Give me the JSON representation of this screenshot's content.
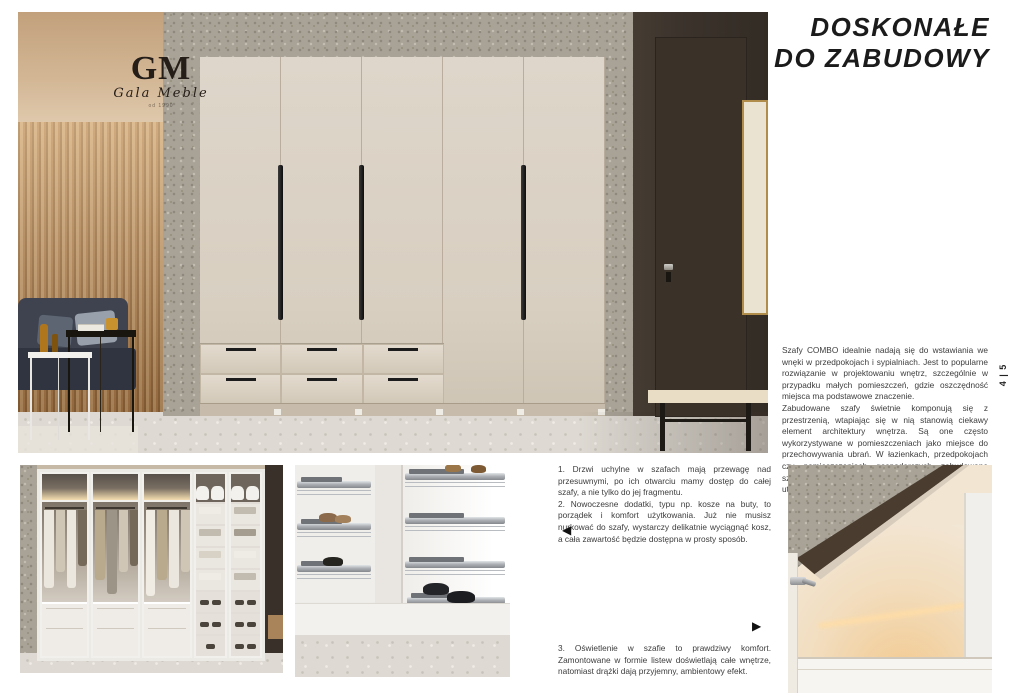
{
  "header": {
    "title_line1": "DOSKONAŁE",
    "title_line2": "DO ZABUDOWY",
    "page_number": "4 | 5"
  },
  "logo": {
    "monogram": "GM",
    "name": "Gala Meble",
    "tagline": "od 1990"
  },
  "intro": {
    "para1": "Szafy COMBO idealnie nadają się do wstawiania we wnęki w przedpokojach i sypialniach. Jest to popularne rozwiązanie w projektowaniu wnętrz, szczególnie w przypadku małych pomieszczeń, gdzie oszczędność miejsca ma podstawowe znaczenie.",
    "para2": "Zabudowane szafy świetnie komponują się z przestrzenią, wtapiając się w nią stanowią ciekawy element architektury wnętrza. Są one często wykorzystywane w pomieszczeniach jako miejsce do przechowywania ubrań. W łazienkach, przedpokojach czy pomieszczeniach gospodarczych zabudowane szafy pozwalają zoptymalizować przestrzeń oraz utrzymać porządek."
  },
  "notes": {
    "item1": "1. Drzwi uchylne w szafach mają przewagę nad przesuwnymi, po ich otwarciu mamy dostęp do całej szafy, a nie tylko do jej fragmentu.",
    "item2": "2. Nowoczesne dodatki, typu np. kosze na buty, to porządek i komfort użytkowania. Już nie musisz nurkować do szafy, wystarczy delikatnie wyciągnąć kosz, a cała zawartość będzie dostępna w prosty sposób.",
    "item3": "3. Oświetlenie w szafie to prawdziwy komfort. Zamontowane w formie listew doświetlają całe wnętrze, natomiast drążki dają przyjemny, ambientowy efekt."
  },
  "icons": {
    "arrow_left": "◀",
    "arrow_right": "▶"
  },
  "colors": {
    "wardrobe_cream": "#d8cec1",
    "granite_gray": "#a8a297",
    "dark_wall": "#3a322b",
    "wood_slat": "#b9905e",
    "frame_gold": "#b08d4a",
    "body_text": "#3c3c3c"
  }
}
